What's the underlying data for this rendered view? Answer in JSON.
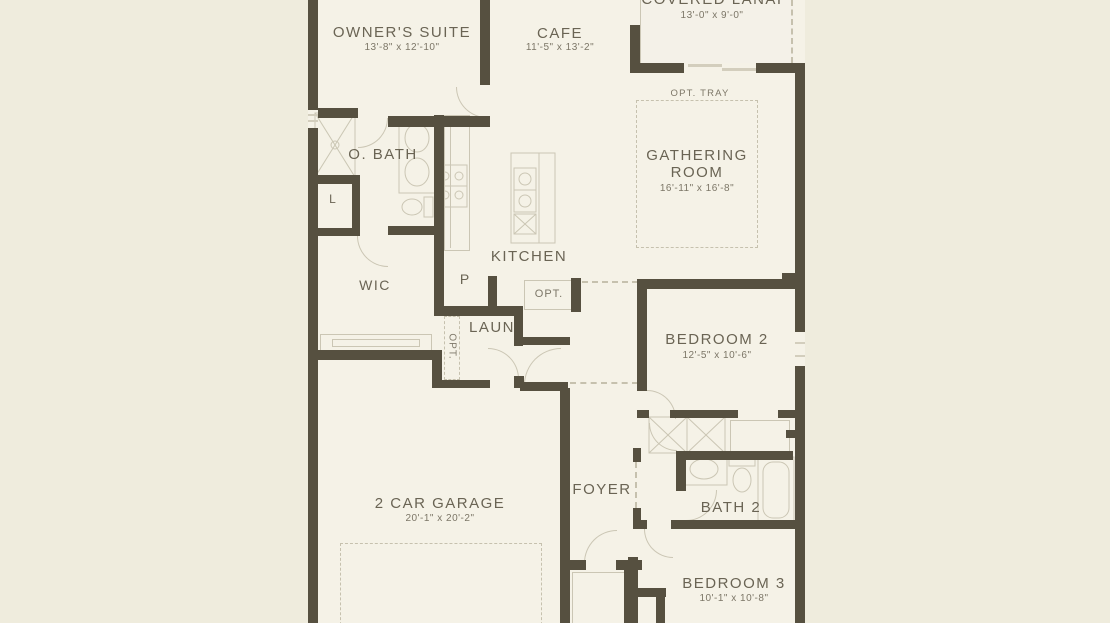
{
  "plan": {
    "rooms": [
      {
        "id": "owners_suite",
        "label": "OWNER'S SUITE",
        "dims": "13'-8\" x 12'-10\""
      },
      {
        "id": "cafe",
        "label": "CAFE",
        "dims": "11'-5\" x 13'-2\""
      },
      {
        "id": "covered_lanai",
        "label": "COVERED LANAI",
        "dims": "13'-0\" x 9'-0\""
      },
      {
        "id": "gathering_room",
        "label_line1": "GATHERING",
        "label_line2": "ROOM",
        "dims": "16'-11\" x 16'-8\""
      },
      {
        "id": "owners_bath",
        "label": "O. BATH"
      },
      {
        "id": "wic",
        "label": "WIC"
      },
      {
        "id": "kitchen",
        "label": "KITCHEN"
      },
      {
        "id": "laundry",
        "label": "LAUN"
      },
      {
        "id": "bedroom2",
        "label": "BEDROOM 2",
        "dims": "12'-5\" x 10'-6\""
      },
      {
        "id": "garage",
        "label": "2 CAR GARAGE",
        "dims": "20'-1\" x 20'-2\""
      },
      {
        "id": "foyer",
        "label": "FOYER"
      },
      {
        "id": "bath2",
        "label": "BATH 2"
      },
      {
        "id": "bedroom3",
        "label": "BEDROOM 3",
        "dims": "10'-1\" x 10'-8\""
      }
    ],
    "annotations": {
      "opt_tray": "OPT. TRAY",
      "opt_kitchen": "OPT.",
      "opt_laundry": "OPT.",
      "linen_closet": "L",
      "pantry": "P"
    },
    "colors": {
      "wall": "#565040",
      "background": "#efecdd",
      "floor": "#f5f2e7",
      "line": "#cbc6b4",
      "line2": "#c6c1ae",
      "text": "#6a6454",
      "dim_text": "#7c7667"
    }
  }
}
